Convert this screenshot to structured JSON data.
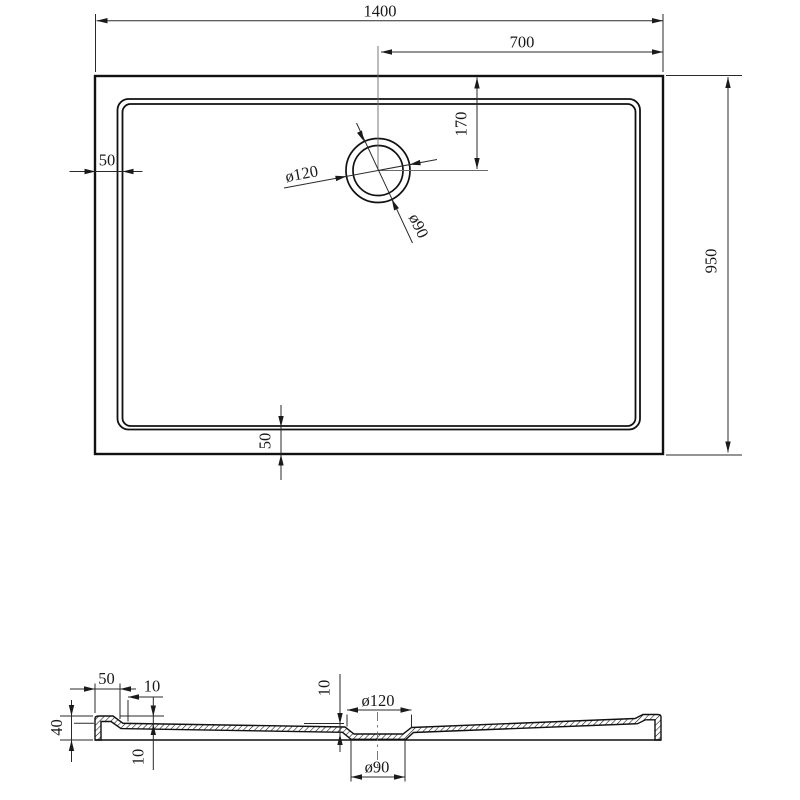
{
  "drawing": {
    "type": "shower-tray technical drawing, plan view and cross-section",
    "top_view": {
      "dim_overall_width": "1400",
      "dim_drain_center_from_right": "700",
      "dim_drain_center_from_top": "170",
      "dim_overall_depth": "950",
      "dim_rim_left": "50",
      "dim_rim_bottom": "50",
      "dim_drain_outer_diameter": "ø120",
      "dim_drain_inner_diameter": "ø90"
    },
    "section_view": {
      "dim_rim_width": "50",
      "dim_rim_step": "10",
      "dim_total_height": "40",
      "dim_inner_depth": "10",
      "dim_drain_recess_depth": "10",
      "dim_drain_outer_diameter": "ø120",
      "dim_drain_inner_diameter": "ø90"
    },
    "colors": {
      "line": "#1a1a1a",
      "background": "#ffffff"
    }
  }
}
